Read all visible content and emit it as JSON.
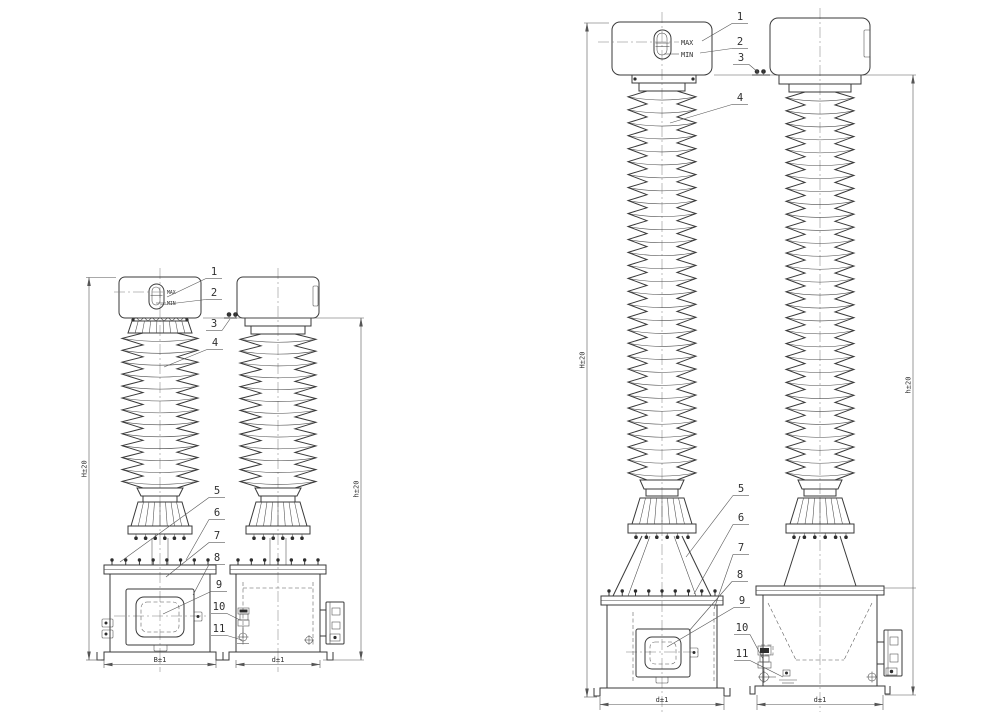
{
  "colors": {
    "background": "#ffffff",
    "line": "#3a3a3a"
  },
  "gauge": {
    "max": "MAX",
    "min": "MIN"
  },
  "callouts": [
    "1",
    "2",
    "3",
    "4",
    "5",
    "6",
    "7",
    "8",
    "9",
    "10",
    "11"
  ],
  "dims": {
    "H": "H±20",
    "h": "h±20",
    "B": "B±1",
    "d": "d±1"
  }
}
